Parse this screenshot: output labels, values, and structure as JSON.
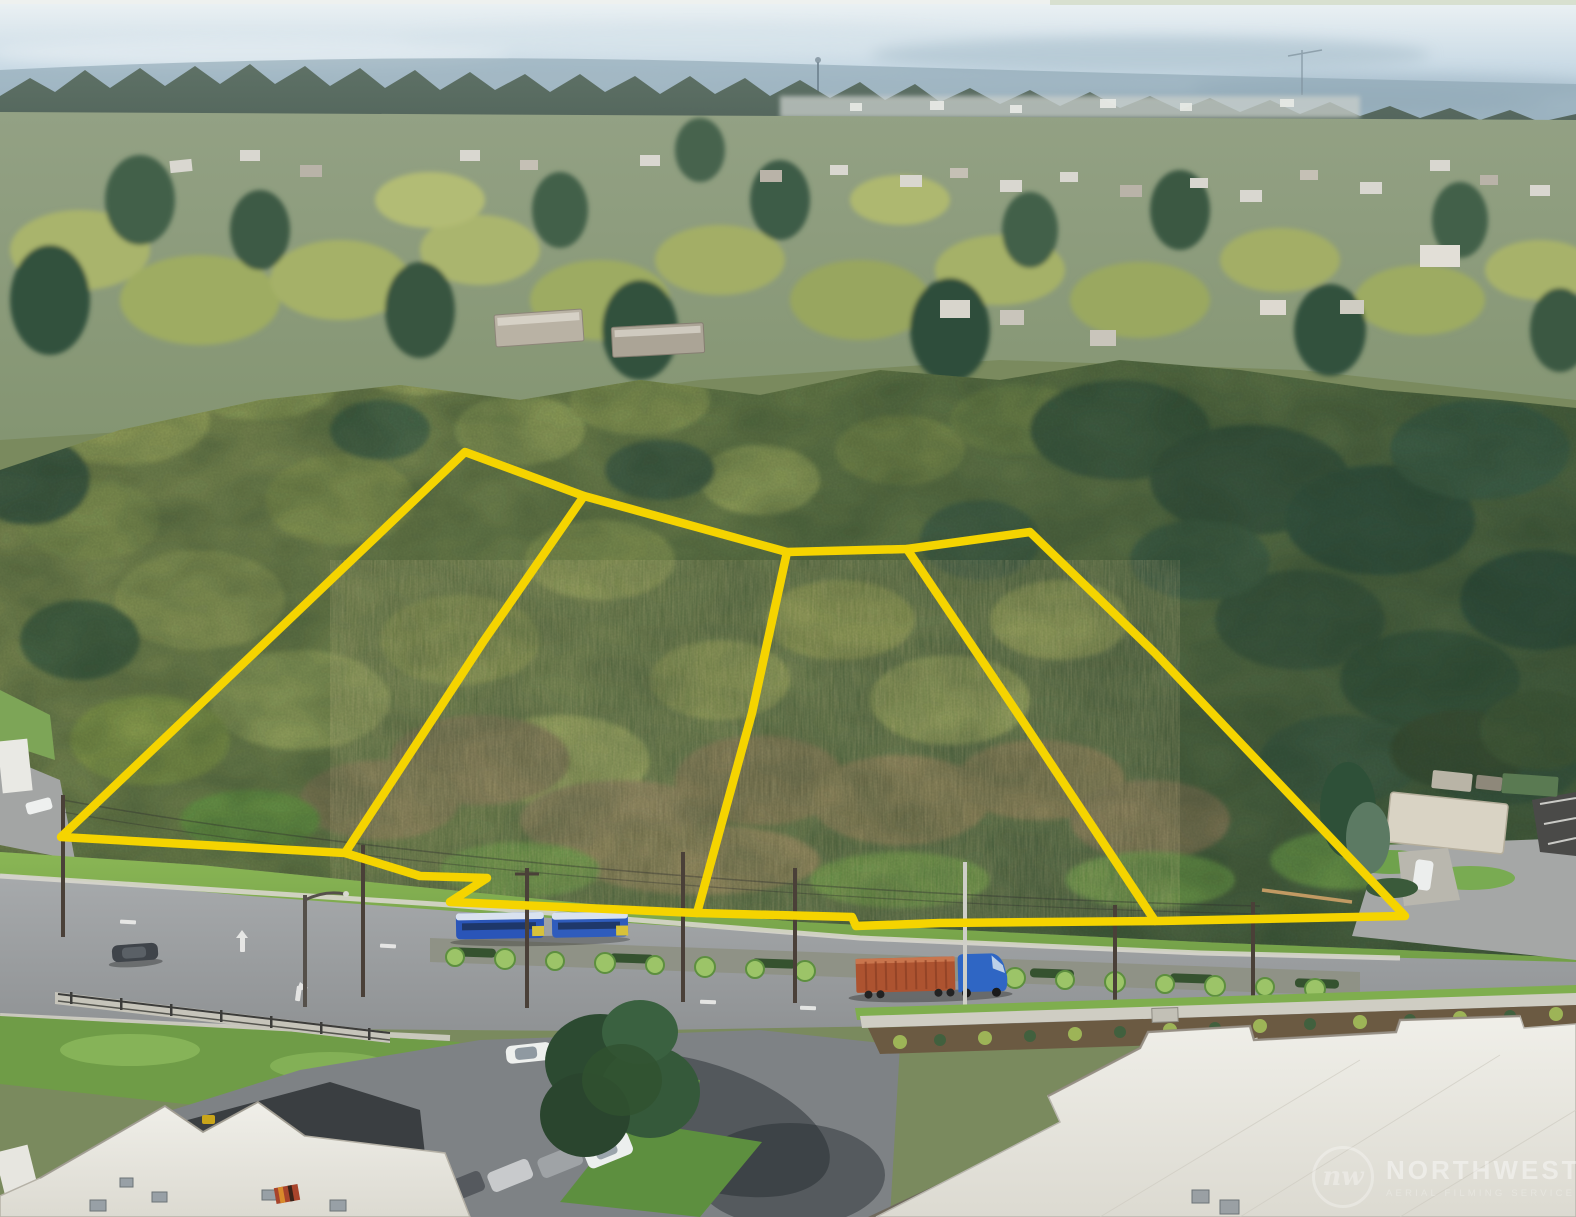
{
  "photo": {
    "description": "aerial-drone-photo-of-wooded-land-parcels-above-arterial-road",
    "accent_yellow": "#F5D400"
  },
  "watermark": {
    "monogram": "nw",
    "brand": "NORTHWEST",
    "tagline": "AERIAL FILMING SERVICE"
  },
  "overlay": {
    "line_color": "#F5D400",
    "line_width": 8.5,
    "boundary": [
      [
        61,
        837
      ],
      [
        465,
        452
      ],
      [
        584,
        496
      ],
      [
        787,
        552
      ],
      [
        907,
        549
      ],
      [
        1030,
        532
      ],
      [
        1155,
        653
      ],
      [
        1405,
        916
      ],
      [
        1160,
        921
      ],
      [
        940,
        923
      ],
      [
        856,
        926
      ],
      [
        852,
        917
      ],
      [
        697,
        913
      ],
      [
        450,
        902
      ],
      [
        487,
        878
      ],
      [
        420,
        876
      ],
      [
        345,
        853
      ]
    ],
    "dividers": [
      [
        [
          584,
          496
        ],
        [
          483,
          642
        ],
        [
          345,
          853
        ]
      ],
      [
        [
          787,
          552
        ],
        [
          752,
          713
        ],
        [
          697,
          913
        ]
      ],
      [
        [
          907,
          549
        ],
        [
          1020,
          717
        ],
        [
          1155,
          921
        ]
      ]
    ]
  }
}
